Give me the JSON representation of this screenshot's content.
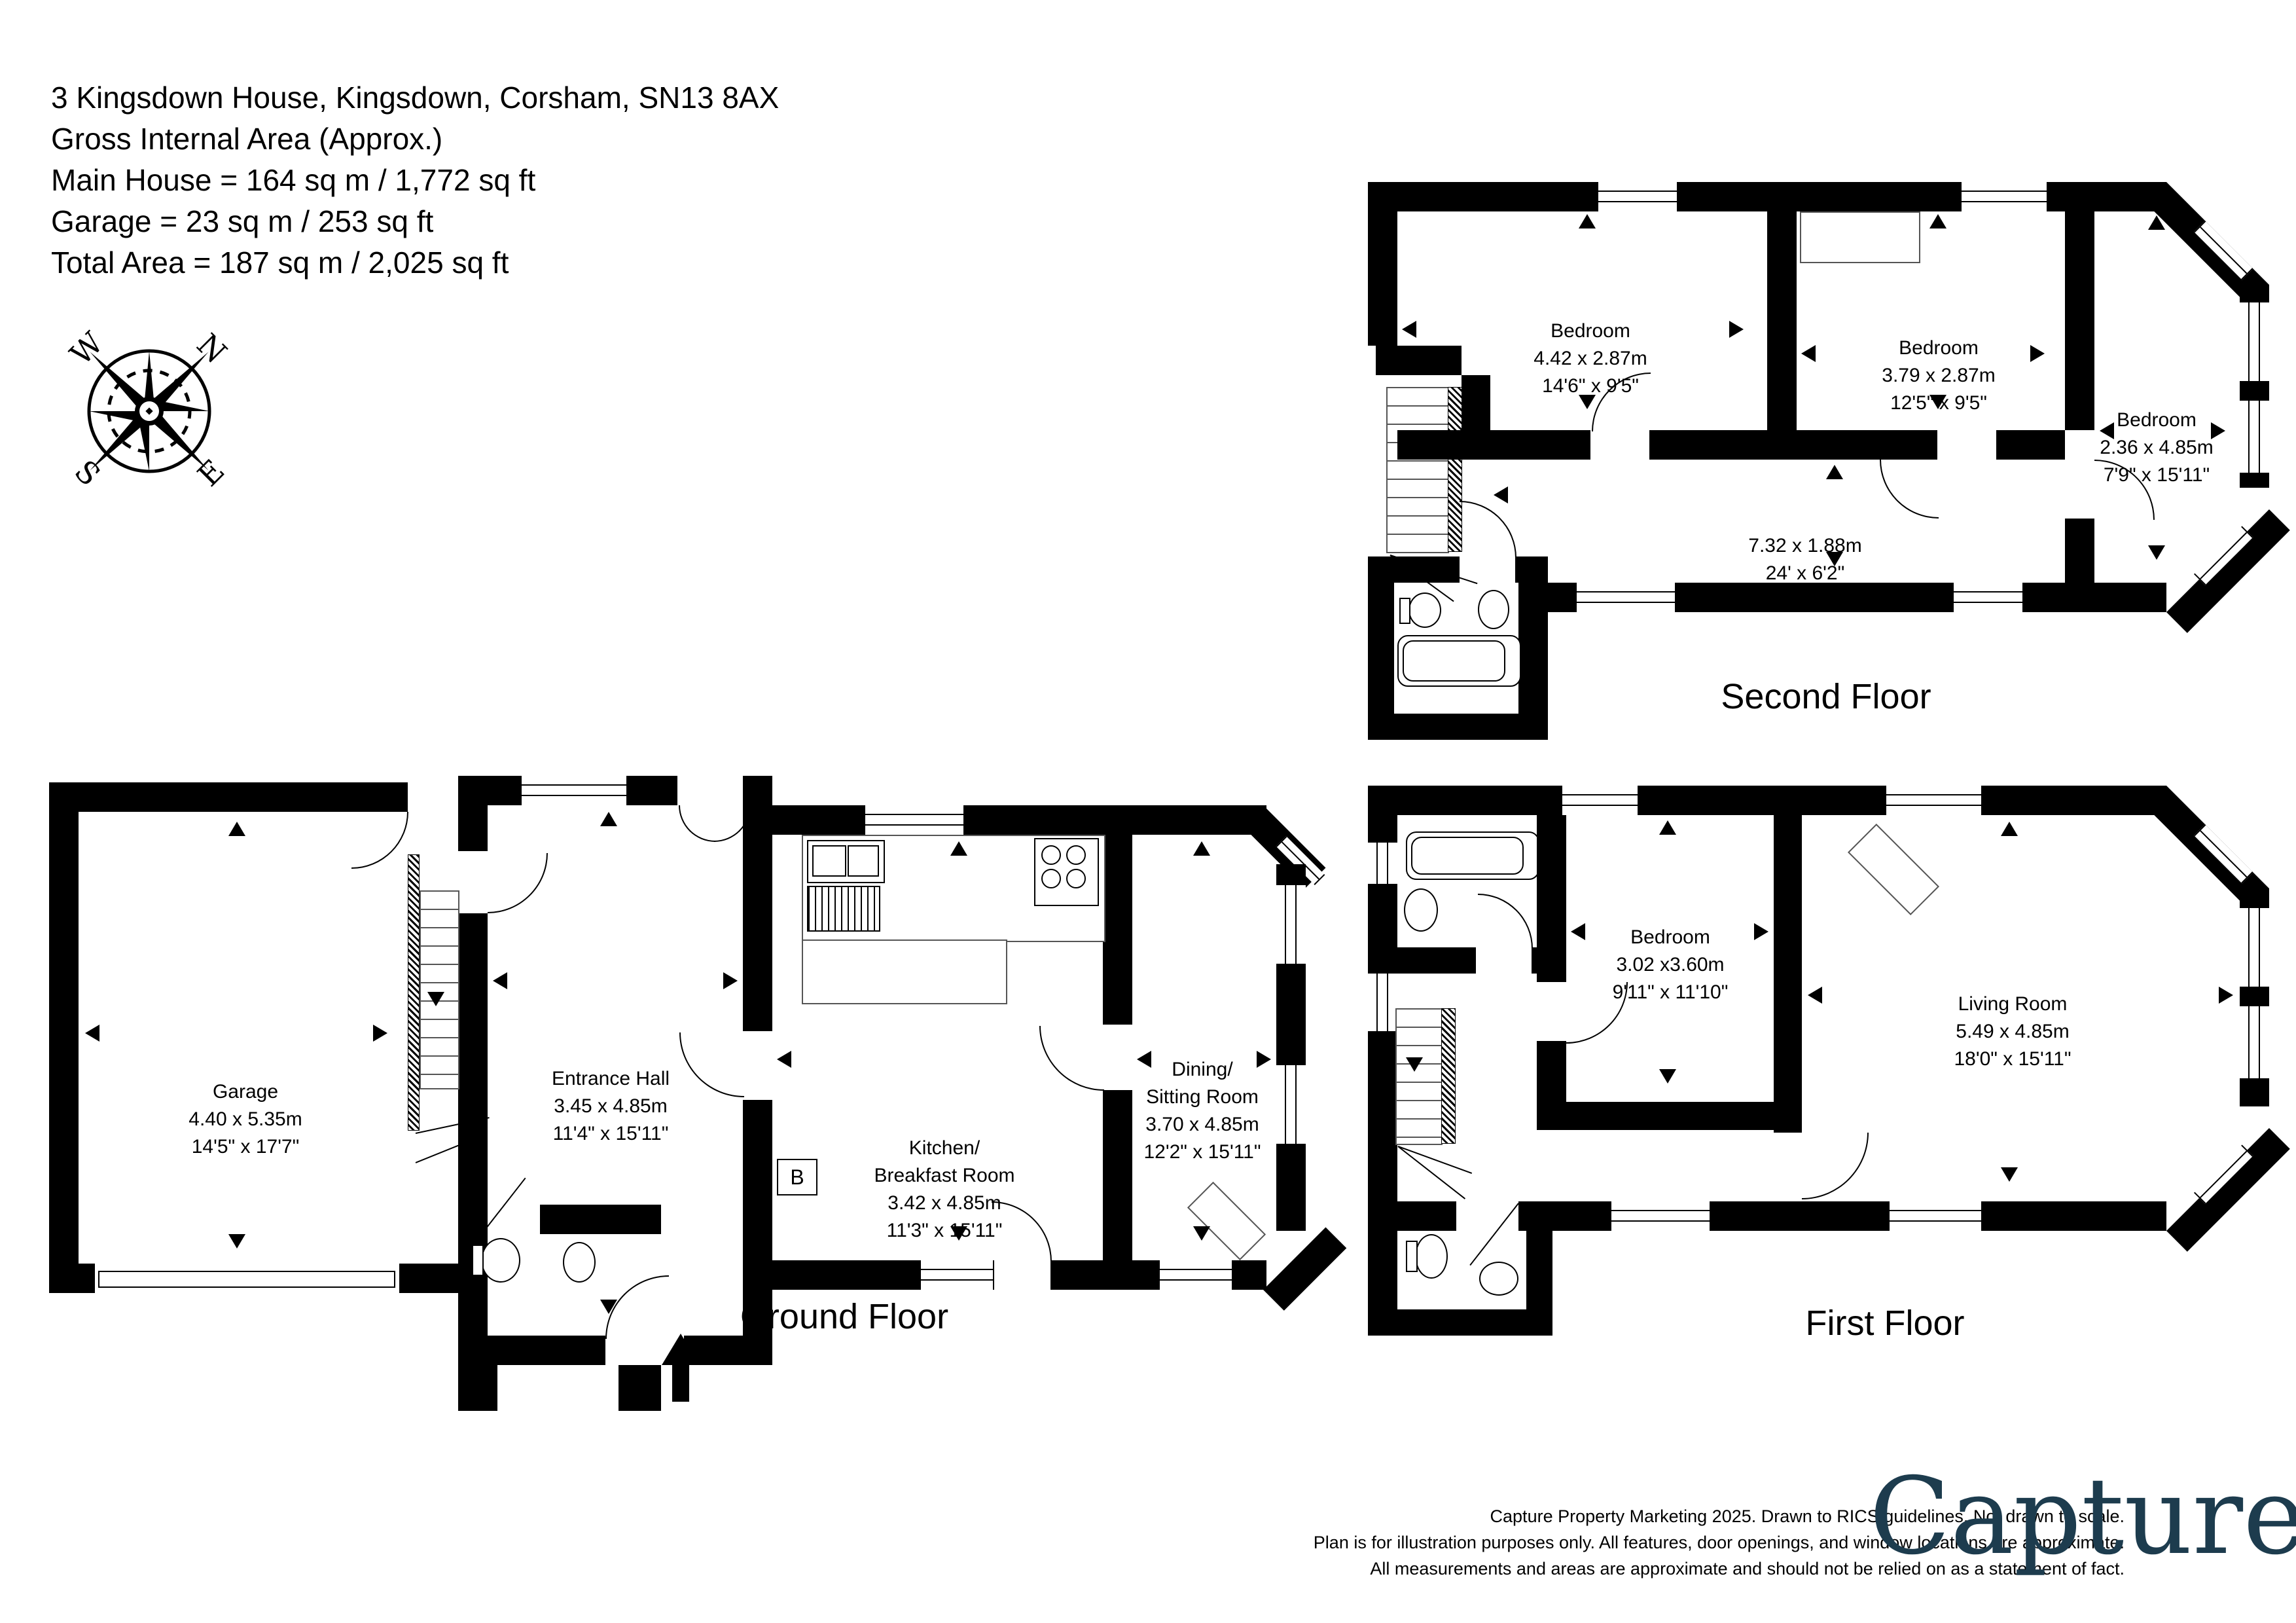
{
  "header": {
    "address": "3 Kingsdown House, Kingsdown, Corsham, SN13 8AX",
    "gia": "Gross Internal Area (Approx.)",
    "main_house": "Main House = 164 sq m / 1,772 sq ft",
    "garage": "Garage = 23 sq m / 253 sq ft",
    "total": "Total Area = 187 sq m / 2,025 sq ft"
  },
  "compass": {
    "n": "N",
    "e": "E",
    "s": "S",
    "w": "W"
  },
  "floors": {
    "ground": {
      "label": "Ground Floor",
      "rooms": {
        "garage": {
          "name": "Garage",
          "metric": "4.40 x 5.35m",
          "imperial": "14'5\" x 17'7\""
        },
        "hall": {
          "name": "Entrance Hall",
          "metric": "3.45 x 4.85m",
          "imperial": "11'4\" x 15'11\""
        },
        "kitchen": {
          "name1": "Kitchen/",
          "name2": "Breakfast Room",
          "metric": "3.42 x 4.85m",
          "imperial": "11'3\" x 15'11\""
        },
        "dining": {
          "name1": "Dining/",
          "name2": "Sitting Room",
          "metric": "3.70 x 4.85m",
          "imperial": "12'2\" x 15'11\""
        }
      }
    },
    "first": {
      "label": "First Floor",
      "rooms": {
        "bedroom": {
          "name": "Bedroom",
          "metric": "3.02 x3.60m",
          "imperial": "9'11\" x 11'10\""
        },
        "living": {
          "name": "Living Room",
          "metric": "5.49 x 4.85m",
          "imperial": "18'0\" x 15'11\""
        }
      }
    },
    "second": {
      "label": "Second Floor",
      "rooms": {
        "bed1": {
          "name": "Bedroom",
          "metric": "4.42 x 2.87m",
          "imperial": "14'6\" x 9'5\""
        },
        "bed2": {
          "name": "Bedroom",
          "metric": "3.79 x 2.87m",
          "imperial": "12'5\" x 9'5\""
        },
        "bed3": {
          "name": "Bedroom",
          "metric": "2.36 x 4.85m",
          "imperial": "7'9\" x 15'11\""
        },
        "landing": {
          "metric": "7.32 x 1.88m",
          "imperial": "24' x 6'2\""
        }
      }
    }
  },
  "annotations": {
    "boiler": "B"
  },
  "footer": {
    "line1": "Capture Property Marketing 2025. Drawn to RICS guidelines.  Not drawn to scale.",
    "line2": "Plan is for illustration purposes only. All features, door openings, and window locations are approximate.",
    "line3": "All measurements and areas are approximate and should not be relied on as a statement of fact.",
    "logo": "Capture",
    "logo_dot": "."
  },
  "colors": {
    "wall": "#000000",
    "logo": "#1d3c4e",
    "logo_dot": "#d91f5e"
  }
}
